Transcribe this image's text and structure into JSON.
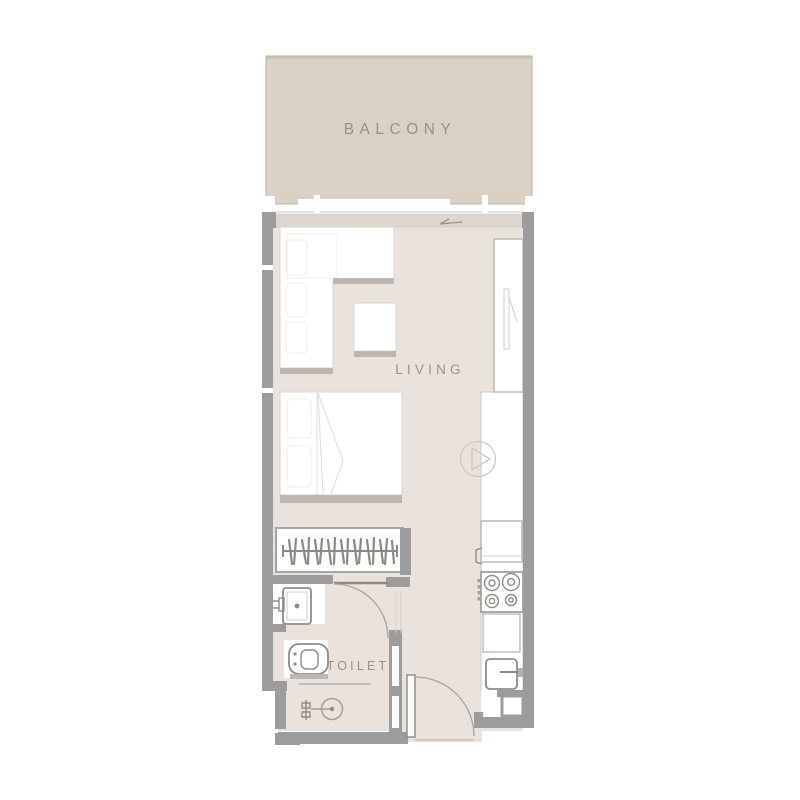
{
  "labels": {
    "balcony": "BALCONY",
    "living": "LIVING",
    "toilet": "TOILET"
  },
  "colors": {
    "background": "#ffffff",
    "balcony_fill": "#dbd1c3",
    "balcony_border": "#bdb3a6",
    "floor_fill": "#eae3dd",
    "wall": "#9c9c9c",
    "shadow": "#beb7b0",
    "label_text": "#97918a",
    "fixture_line": "#8f8b87",
    "furniture_line": "#d8d4d0"
  },
  "fixtures": [
    {
      "name": "balcony-sliding-door"
    },
    {
      "name": "l-shaped-sofa"
    },
    {
      "name": "coffee-table"
    },
    {
      "name": "double-bed"
    },
    {
      "name": "wardrobe-with-hangers"
    },
    {
      "name": "tall-closet"
    },
    {
      "name": "kitchen-counter"
    },
    {
      "name": "round-sink"
    },
    {
      "name": "kitchen-cabinet"
    },
    {
      "name": "stove-4-burner"
    },
    {
      "name": "kitchen-sink"
    },
    {
      "name": "alcove-cabinet"
    },
    {
      "name": "washbasin"
    },
    {
      "name": "wc-toilet"
    },
    {
      "name": "shower-drain"
    },
    {
      "name": "toilet-door"
    },
    {
      "name": "entry-door"
    },
    {
      "name": "entrance-arrow"
    }
  ]
}
